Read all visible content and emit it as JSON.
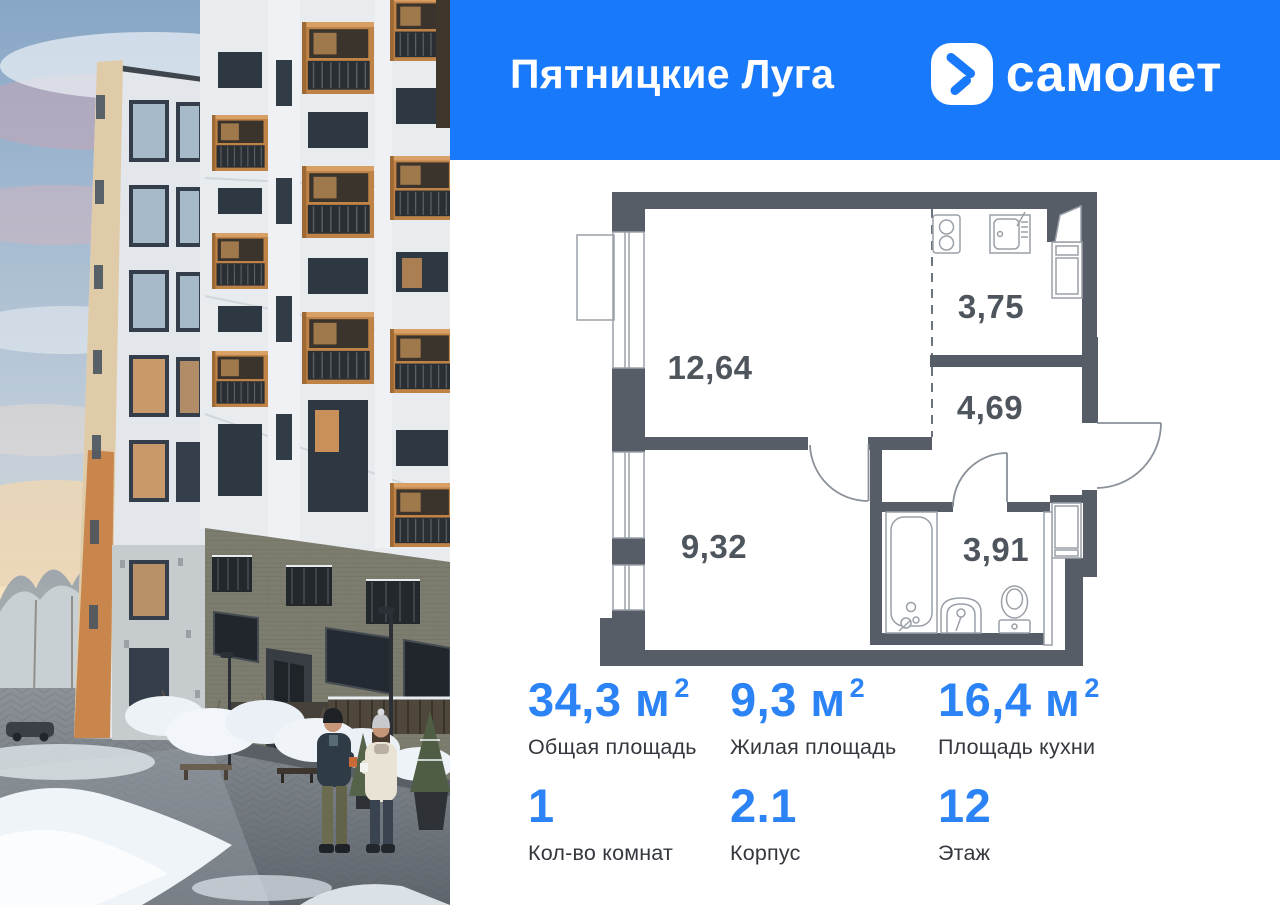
{
  "header": {
    "project_name": "Пятницкие Луга",
    "brand_name": "самолет"
  },
  "floor_plan": {
    "rooms": [
      {
        "id": "living-room",
        "area": "12,64"
      },
      {
        "id": "kitchen",
        "area": "3,75"
      },
      {
        "id": "hallway",
        "area": "4,69"
      },
      {
        "id": "bedroom",
        "area": "9,32"
      },
      {
        "id": "bathroom",
        "area": "3,91"
      }
    ]
  },
  "stats": {
    "items": [
      {
        "value": "34,3 м",
        "sup": "2",
        "label": "Общая площадь"
      },
      {
        "value": "9,3 м",
        "sup": "2",
        "label": "Жилая площадь"
      },
      {
        "value": "16,4 м",
        "sup": "2",
        "label": "Площадь кухни"
      },
      {
        "value": "1",
        "sup": "",
        "label": "Кол-во комнат"
      },
      {
        "value": "2.1",
        "sup": "",
        "label": "Корпус"
      },
      {
        "value": "12",
        "sup": "",
        "label": "Этаж"
      }
    ]
  },
  "colors": {
    "brand_blue": "#1879FA",
    "stat_number_blue": "#2C83F6",
    "wall_gray": "#575D67",
    "balcony_orange": "#C08347"
  }
}
